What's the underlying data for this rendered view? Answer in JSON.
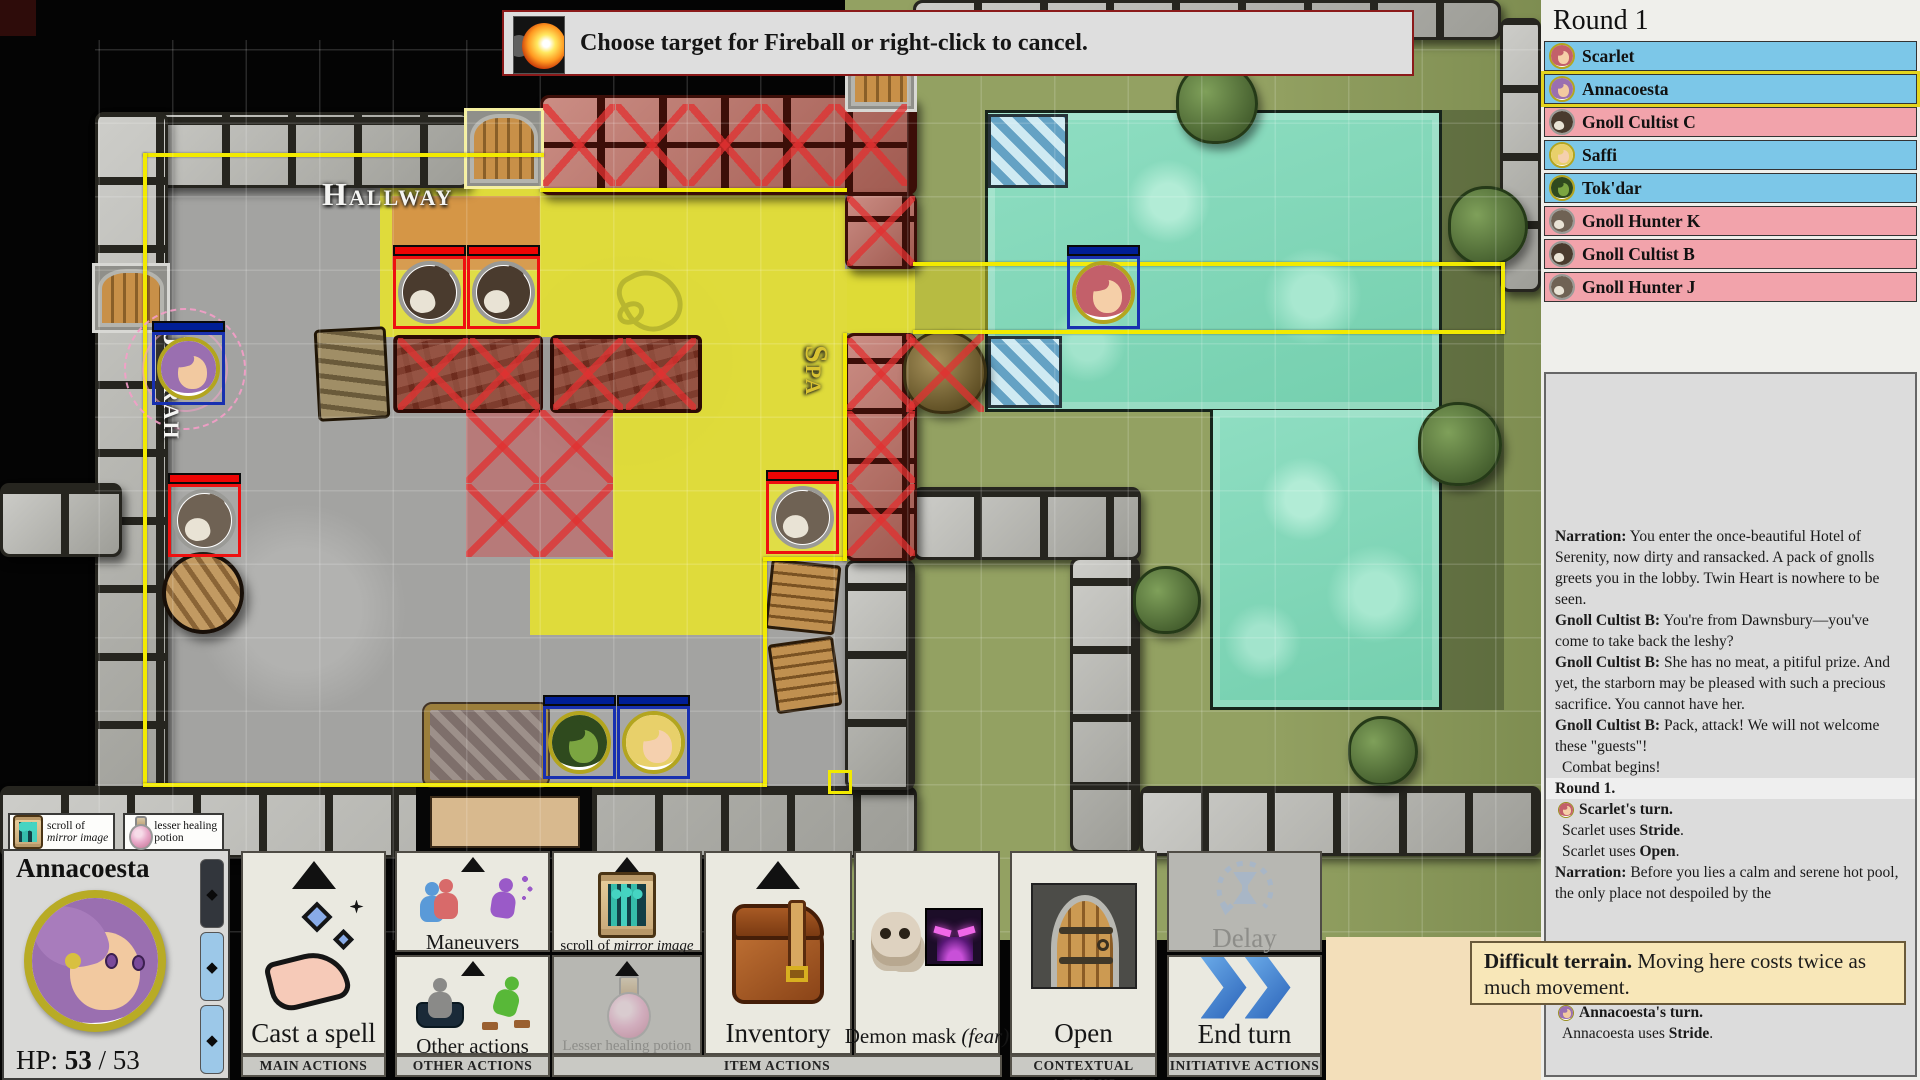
{
  "banner": {
    "text": "Choose target for Fireball or right-click to cancel.",
    "icon": "fireball-icon"
  },
  "initiative": {
    "round_label": "Round 1",
    "entries": [
      {
        "name": "Scarlet",
        "side": "ally",
        "icon": "scarlet",
        "active": false
      },
      {
        "name": "Annacoesta",
        "side": "ally",
        "icon": "annacoesta",
        "active": true
      },
      {
        "name": "Gnoll Cultist C",
        "side": "enemy",
        "icon": "gnoll-dark",
        "active": false
      },
      {
        "name": "Saffi",
        "side": "ally",
        "icon": "saffi",
        "active": false
      },
      {
        "name": "Tok'dar",
        "side": "ally",
        "icon": "tokdar",
        "active": false
      },
      {
        "name": "Gnoll Hunter K",
        "side": "enemy",
        "icon": "gnoll-gray",
        "active": false
      },
      {
        "name": "Gnoll Cultist B",
        "side": "enemy",
        "icon": "gnoll-dark",
        "active": false
      },
      {
        "name": "Gnoll Hunter J",
        "side": "enemy",
        "icon": "gnoll-gray",
        "active": false
      }
    ]
  },
  "log": {
    "entries": [
      {
        "type": "speech",
        "speaker": "Narration:",
        "text": "You enter the once-beautiful Hotel of Serenity, now dirty and ransacked. A pack of gnolls greets you in the lobby. Twin Heart is nowhere to be seen."
      },
      {
        "type": "speech",
        "speaker": "Gnoll Cultist B:",
        "text": "You're from Dawnsbury—you've come to take back the leshy?"
      },
      {
        "type": "speech",
        "speaker": "Gnoll Cultist B:",
        "text": "She has no meat, a pitiful prize. And yet, the starborn may be pleased with such a precious sacrifice. You cannot have her."
      },
      {
        "type": "speech",
        "speaker": "Gnoll Cultist B:",
        "text": "Pack, attack! We will not welcome these \"guests\"!"
      },
      {
        "type": "plain",
        "text": "Combat begins!"
      },
      {
        "type": "round",
        "text": "Round 1."
      },
      {
        "type": "turn",
        "icon": "scarlet",
        "text": "Scarlet's turn."
      },
      {
        "type": "action",
        "pre": "Scarlet uses ",
        "bold": "Stride",
        "post": "."
      },
      {
        "type": "action",
        "pre": "Scarlet uses ",
        "bold": "Open",
        "post": "."
      },
      {
        "type": "speech",
        "speaker": "Narration:",
        "text": "Before you lies a calm and serene hot pool, the only place not despoiled by the"
      },
      {
        "type": "spacer",
        "height": 56
      },
      {
        "type": "plain",
        "text": "a dip..."
      },
      {
        "type": "action",
        "pre": "Scarlet uses ",
        "bold": "Stride",
        "post": "."
      },
      {
        "type": "turn",
        "icon": "annacoesta",
        "text": "Annacoesta's turn."
      },
      {
        "type": "action",
        "pre": "Annacoesta uses ",
        "bold": "Stride",
        "post": "."
      }
    ]
  },
  "tooltip": {
    "lead": "Difficult terrain.",
    "rest": " Moving here costs twice as much movement."
  },
  "character": {
    "name": "Annacoesta",
    "hp_label": "HP:",
    "hp_current": "53",
    "hp_sep": "/",
    "hp_max": "53",
    "action_pips": [
      {
        "state": "used"
      },
      {
        "state": "ready"
      },
      {
        "state": "ready"
      }
    ]
  },
  "quickslots": [
    {
      "line1": "scroll of",
      "line2": "mirror image",
      "italic_line2": true,
      "icon": "scroll-icon"
    },
    {
      "line1": "lesser healing",
      "line2": "potion",
      "italic_line2": false,
      "icon": "potion-icon"
    }
  ],
  "action_bar": {
    "groups": [
      {
        "footer": "MAIN ACTIONS",
        "columns": [
          [
            {
              "name": "cast-a-spell",
              "label": "Cast a spell",
              "icon": "cast-spell",
              "arrow": "big"
            }
          ]
        ]
      },
      {
        "footer": "OTHER ACTIONS",
        "columns": [
          [
            {
              "name": "maneuvers",
              "label": "Maneuvers",
              "icon": "maneuvers",
              "arrow": "small",
              "label_size": "mid"
            },
            {
              "name": "other-actions",
              "label": "Other actions",
              "icon": "other-actions",
              "arrow": "small",
              "label_size": "mid"
            }
          ]
        ]
      },
      {
        "footer": "ITEM ACTIONS",
        "columns": [
          [
            {
              "name": "scroll-of-mirror-image",
              "label_pre": "scroll of ",
              "label_italic": "mirror image",
              "icon": "scroll",
              "arrow": "small",
              "label_size": "small"
            },
            {
              "name": "lesser-healing-potion",
              "label": "Lesser healing potion",
              "icon": "potion",
              "arrow": "small",
              "disabled": true,
              "label_size": "small"
            }
          ],
          [
            {
              "name": "inventory",
              "label": "Inventory",
              "icon": "backpack",
              "arrow": "big"
            }
          ],
          [
            {
              "name": "demon-mask",
              "label_pre": "Demon mask ",
              "label_italic": "(fear)",
              "icon": "demon-mask",
              "label_size": "mid"
            }
          ]
        ]
      },
      {
        "footer": "CONTEXTUAL ACTIONS",
        "columns": [
          [
            {
              "name": "open",
              "label": "Open",
              "icon": "door"
            }
          ]
        ]
      },
      {
        "footer": "INITIATIVE ACTIONS",
        "columns": [
          [
            {
              "name": "delay",
              "label": "Delay",
              "icon": "delay",
              "disabled": true
            },
            {
              "name": "end-turn",
              "label": "End turn",
              "icon": "end-turn"
            }
          ]
        ]
      }
    ]
  },
  "map": {
    "labels": {
      "hallway": "Hallway",
      "spa": "Spa",
      "jarrah": "Jarrah"
    },
    "tokens": [
      {
        "id": "annacoesta",
        "x": 152,
        "y": 332,
        "side": "ally",
        "icon": "annacoesta",
        "aura": true
      },
      {
        "id": "gnoll-cultist-1",
        "x": 393,
        "y": 256,
        "side": "enemy",
        "icon": "gnoll-dark"
      },
      {
        "id": "gnoll-cultist-2",
        "x": 467,
        "y": 256,
        "side": "enemy",
        "icon": "gnoll-dark"
      },
      {
        "id": "gnoll-hunter-left",
        "x": 168,
        "y": 484,
        "side": "enemy",
        "icon": "gnoll-gray"
      },
      {
        "id": "gnoll-hunter-right",
        "x": 766,
        "y": 481,
        "side": "enemy",
        "icon": "gnoll-gray"
      },
      {
        "id": "scarlet",
        "x": 1067,
        "y": 256,
        "side": "ally",
        "icon": "scarlet"
      },
      {
        "id": "tokdar",
        "x": 543,
        "y": 706,
        "side": "ally",
        "icon": "tokdar"
      },
      {
        "id": "saffi",
        "x": 617,
        "y": 706,
        "side": "ally",
        "icon": "saffi"
      }
    ],
    "faces": {
      "scarlet": {
        "hair": "#c3606a",
        "skin": "#f5cfa8"
      },
      "annacoesta": {
        "hair": "#9a6fb0",
        "skin": "#f2c9a0"
      },
      "saffi": {
        "hair": "#e8d06a",
        "skin": "#f5d0ae"
      },
      "tokdar": {
        "hair": "#2f4a1e",
        "skin": "#7ba541"
      },
      "gnoll-dark": {
        "fur": "#4a3b2e"
      },
      "gnoll-gray": {
        "fur": "#6f6254"
      }
    }
  },
  "palette": {
    "ally_row": "#7cc7e8",
    "enemy_row": "#f2a3ab",
    "ally_border": "#1830b0",
    "enemy_border": "#ee1010",
    "ally_hp": "#001e96",
    "enemy_hp": "#ee0404",
    "ally_ring": "#b3a51f",
    "gnoll_ring": "#9a9a96",
    "aoe_yellow": "#e4e032",
    "aoe_outline": "#f2ea00",
    "blocked_red": "#cb5252",
    "tooltip_bg": "#f8e7b8",
    "pool": "#84d8bc",
    "grass": "#8f9d5f",
    "floor": "#a3a3a1"
  }
}
